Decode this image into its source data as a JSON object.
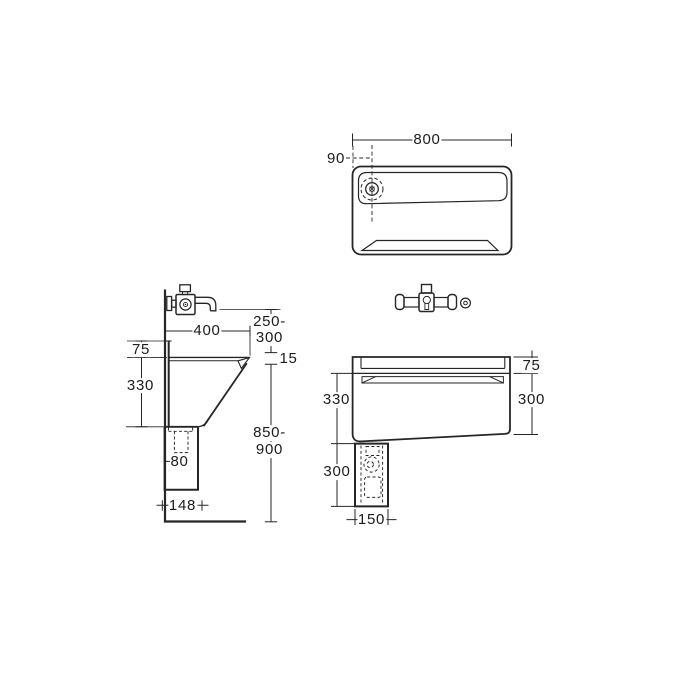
{
  "colors": {
    "line": "#262626",
    "background": "#ffffff"
  },
  "plan_view": {
    "width_dim": "800",
    "drain_offset_dim": "90"
  },
  "side_view": {
    "depth_dim": "400",
    "spout_clearance_line1": "250-",
    "spout_clearance_line2": "300",
    "rim_thickness_dim": "15",
    "upstand_dim": "75",
    "bowl_depth_dim": "330",
    "mount_height_line1": "850-",
    "mount_height_line2": "900",
    "trap_width_dim": "80",
    "duct_depth_dim": "148"
  },
  "front_view": {
    "upstand_dim": "75",
    "bowl_depth_dim": "330",
    "bowl_front_height_dim": "300",
    "duct_height_dim": "300",
    "duct_width_dim": "150"
  }
}
